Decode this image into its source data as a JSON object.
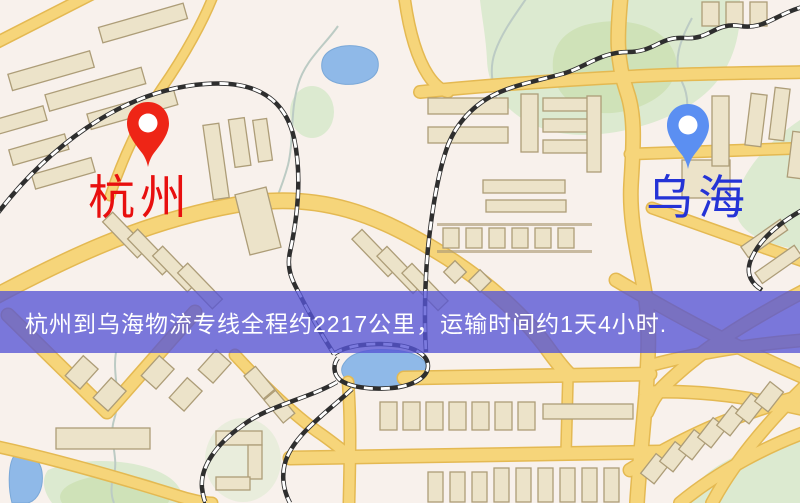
{
  "banner": {
    "text": "杭州到乌海物流专线全程约2217公里，运输时间约1天4小时.",
    "origin": "杭州",
    "destination": "乌海",
    "distance": "约2217公里",
    "duration": "约1天4小时"
  },
  "markers": {
    "origin": {
      "label": "杭州",
      "pin_color": "#ee2516",
      "label_color": "#e80f0f"
    },
    "destination": {
      "label": "乌海",
      "pin_color": "#5b8ff2",
      "label_color": "#2433d6"
    }
  },
  "colors": {
    "map-bg": "#f8f1ec",
    "road-fill": "#f6d57a",
    "road-casing": "#e4b952",
    "building-fill": "#ece3c9",
    "building-stroke": "#ad9d78",
    "green": "#dcead0",
    "green-dark": "#cfe2b8",
    "water": "#8fb9e8",
    "rail-dark": "#2e2e2e",
    "rail-light": "#ffffff",
    "stream": "#bccbc4",
    "banner-bg": "rgba(86,84,213,0.78)",
    "banner-text": "#ffffff",
    "pin-red": "#ee2516",
    "pin-blue": "#5b8ff2",
    "label-red": "#e80f0f",
    "label-blue": "#2433d6"
  }
}
